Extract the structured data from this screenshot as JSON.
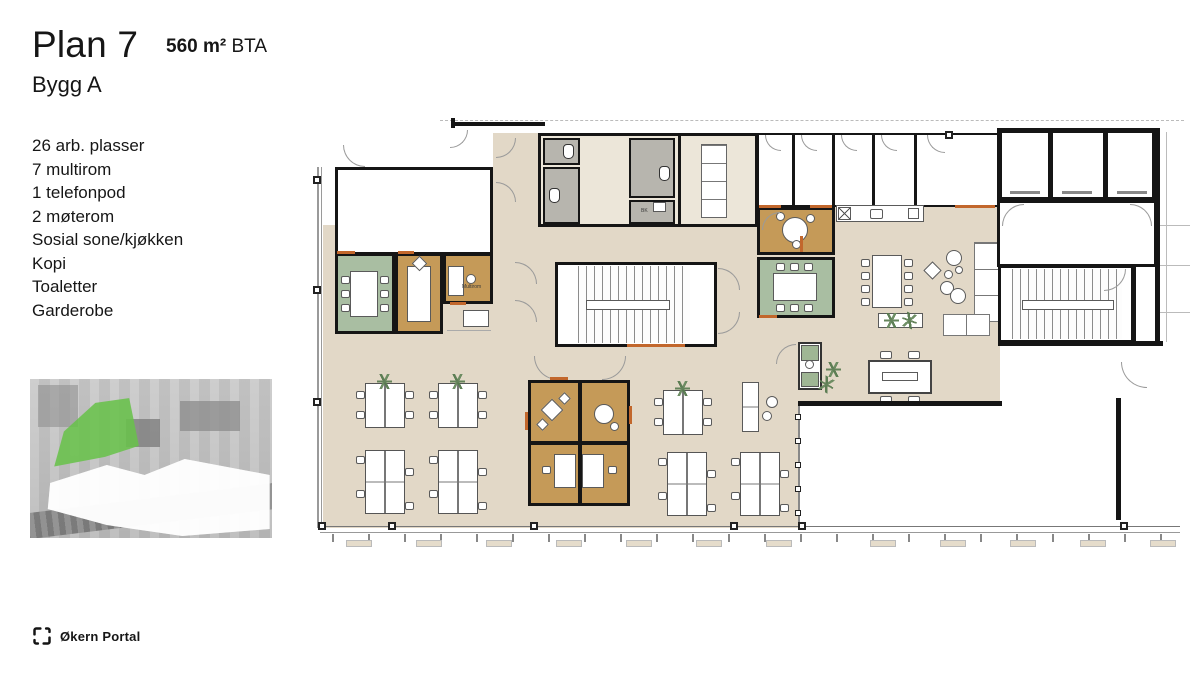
{
  "header": {
    "title": "Plan 7",
    "area_value": "560 m²",
    "area_unit": " BTA",
    "building": "Bygg A"
  },
  "features": {
    "items": [
      "26 arb. plasser",
      "7 multirom",
      "1 telefonpod",
      "2 møterom",
      "Sosial sone/kjøkken",
      "Kopi",
      "Toaletter",
      "Garderobe"
    ]
  },
  "floorplan": {
    "labels": {
      "multirom": "Multirom",
      "bk": "BK"
    },
    "colors": {
      "floor": "#e2d8c7",
      "meeting_room": "#a9bea2",
      "multirom": "#c59a58",
      "toilet": "#b7b5ae",
      "wall": "#151515",
      "accent": "#c2672c",
      "highlight_building": "#69c24b"
    }
  },
  "footer": {
    "logo_text": "Økern Portal"
  }
}
